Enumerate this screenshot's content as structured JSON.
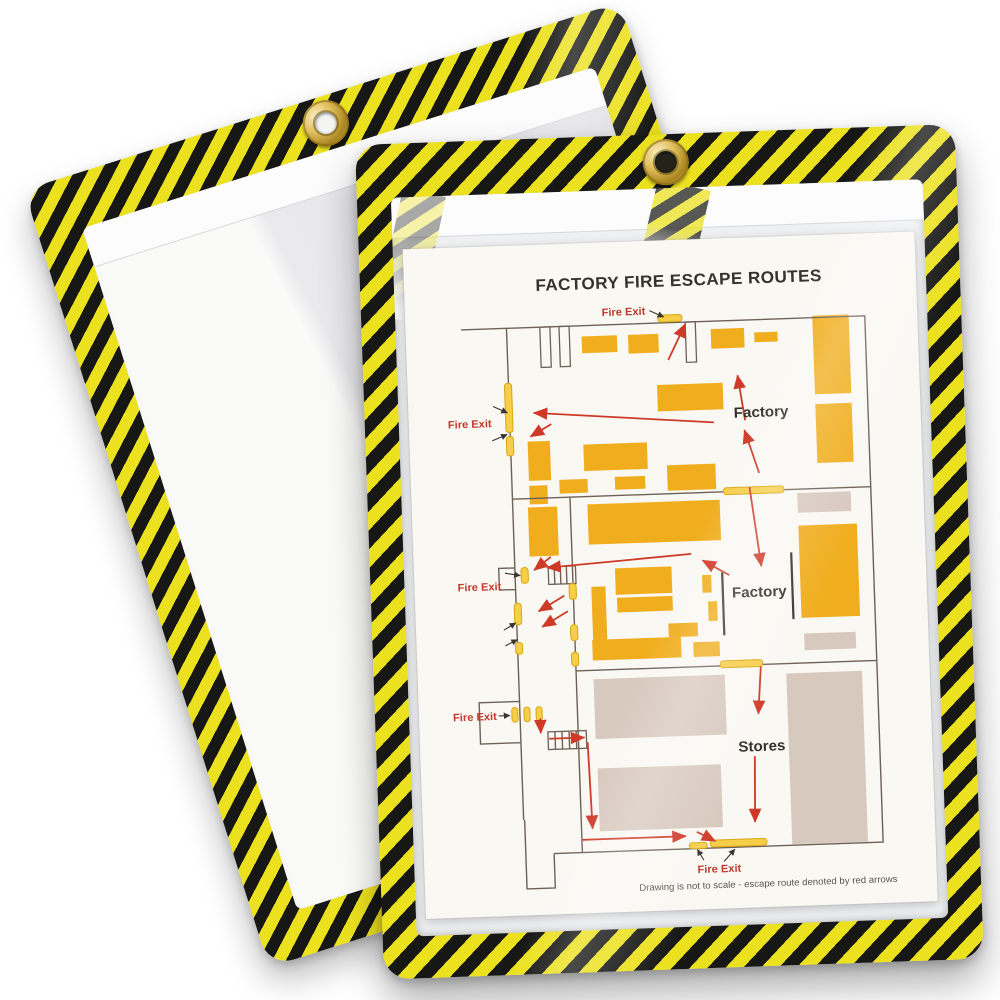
{
  "scene": {
    "background_color": "#ffffff"
  },
  "back_holder": {
    "kind": "empty shop ticket holder",
    "watermark_lines": [
      "m",
      "080-9470"
    ]
  },
  "front_holder": {
    "kind": "shop ticket holder with document"
  },
  "colors": {
    "stripe_yellow": "#ece11f",
    "stripe_black": "#171715",
    "grommet_brass": "#d2ad45",
    "machine_yellow": "#f0ae1f",
    "stores_beige": "#d8c9be",
    "route_red": "#cf3a28",
    "wall_brown": "#6e6257",
    "fire_exit_red": "#c1392b"
  },
  "document": {
    "title": "FACTORY FIRE ESCAPE ROUTES",
    "footnote": "Drawing is not to scale - escape route denoted by red arrows",
    "fire_exit_labels": [
      "Fire Exit",
      "Fire Exit",
      "Fire Exit",
      "Fire Exit",
      "Fire Exit"
    ],
    "area_labels": [
      "Factory",
      "Factory",
      "Stores"
    ]
  }
}
